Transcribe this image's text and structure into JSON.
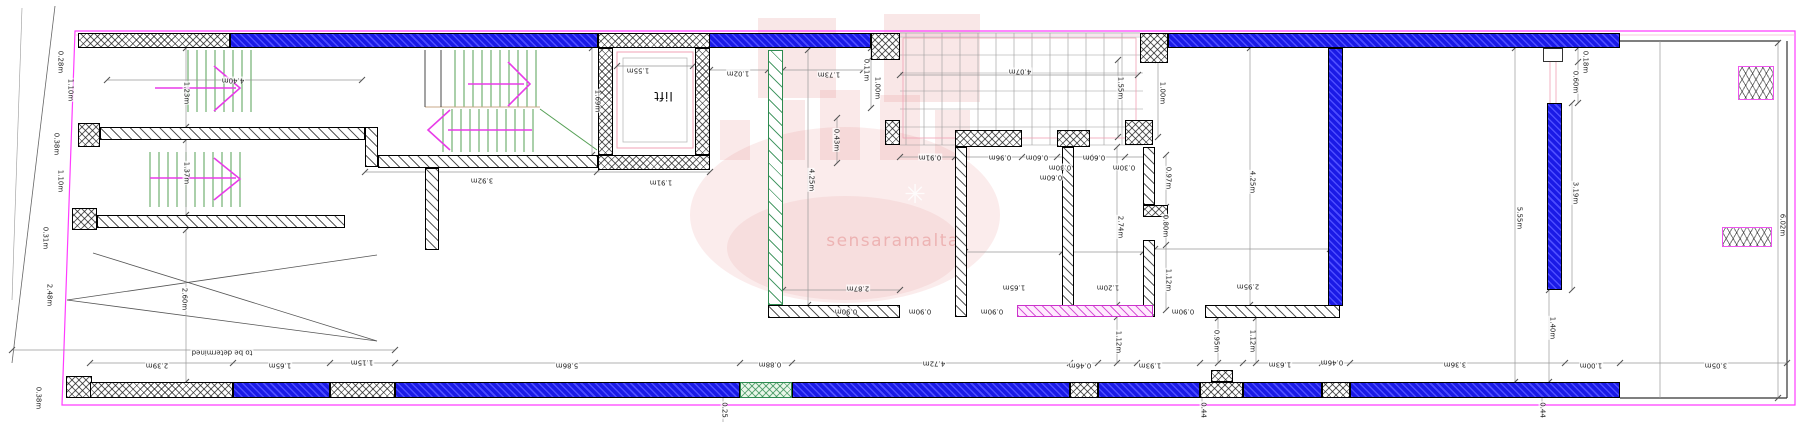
{
  "plan": {
    "type": "architectural-floor-plan",
    "units": "m",
    "watermark": "sensaramalta",
    "lift_label": "lift",
    "note": "to be determined"
  },
  "colors": {
    "wall_blue": "#1a1ae6",
    "wall_blue_hatch": "#4d4dff",
    "hatch_black": "#333333",
    "stair_green": "#55a055",
    "wall_green": "#2e8b50",
    "arrow_magenta": "#e83ce8",
    "boundary_magenta": "#ff3cff",
    "wall_magenta": "#cc33cc",
    "dim_line": "#999999",
    "aux_pink": "#f0a0b4",
    "watermark_red": "#e07878"
  },
  "labels": [
    {
      "t": "0.28m",
      "x": 60,
      "y": 62,
      "r": 90
    },
    {
      "t": "1.10m",
      "x": 70,
      "y": 90,
      "r": 90
    },
    {
      "t": "0.38m",
      "x": 56,
      "y": 144,
      "r": 90
    },
    {
      "t": "1.10m",
      "x": 60,
      "y": 181,
      "r": 90
    },
    {
      "t": "0.31m",
      "x": 45,
      "y": 238,
      "r": 90
    },
    {
      "t": "2.48m",
      "x": 49,
      "y": 295,
      "r": 90
    },
    {
      "t": "0.38m",
      "x": 38,
      "y": 398,
      "r": 90
    },
    {
      "t": "1.23m",
      "x": 186,
      "y": 93,
      "r": 90
    },
    {
      "t": "4.40m",
      "x": 233,
      "y": 80,
      "r": 180
    },
    {
      "t": "1.37m",
      "x": 186,
      "y": 173,
      "r": 90
    },
    {
      "t": "2.60m",
      "x": 184,
      "y": 299,
      "r": 90
    },
    {
      "t": "3.92m",
      "x": 482,
      "y": 180,
      "r": 180
    },
    {
      "t": "1.69m",
      "x": 597,
      "y": 101,
      "r": 90
    },
    {
      "t": "1.55m",
      "x": 638,
      "y": 70,
      "r": 180
    },
    {
      "t": "lift",
      "x": 663,
      "y": 96,
      "r": 180,
      "n": "lift-label"
    },
    {
      "t": "1.91m",
      "x": 661,
      "y": 182,
      "r": 180
    },
    {
      "t": "1.02m",
      "x": 738,
      "y": 73,
      "r": 180
    },
    {
      "t": "1.73m",
      "x": 829,
      "y": 74,
      "r": 180
    },
    {
      "t": "0.11m",
      "x": 866,
      "y": 70,
      "r": 90
    },
    {
      "t": "1.00m",
      "x": 877,
      "y": 88,
      "r": 90
    },
    {
      "t": "0.43m",
      "x": 836,
      "y": 140,
      "r": 90
    },
    {
      "t": "4.25m",
      "x": 811,
      "y": 180,
      "r": 90
    },
    {
      "t": "4.07m",
      "x": 1020,
      "y": 71,
      "r": 180
    },
    {
      "t": "1.55m",
      "x": 1120,
      "y": 88,
      "r": 90
    },
    {
      "t": "1.00m",
      "x": 1162,
      "y": 93,
      "r": 90
    },
    {
      "t": "0.91m",
      "x": 930,
      "y": 157,
      "r": 180
    },
    {
      "t": "0.96m",
      "x": 1000,
      "y": 157,
      "r": 180
    },
    {
      "t": "0.60m",
      "x": 1037,
      "y": 157,
      "r": 180
    },
    {
      "t": "0.30m",
      "x": 1060,
      "y": 167,
      "r": 180
    },
    {
      "t": "0.60m",
      "x": 1094,
      "y": 157,
      "r": 180
    },
    {
      "t": "0.30m",
      "x": 1124,
      "y": 167,
      "r": 180
    },
    {
      "t": "0.60m",
      "x": 1051,
      "y": 177,
      "r": 180
    },
    {
      "t": "0.97m",
      "x": 1168,
      "y": 178,
      "r": 90
    },
    {
      "t": "0.80m",
      "x": 1165,
      "y": 226,
      "r": 90
    },
    {
      "t": "2.74m",
      "x": 1120,
      "y": 227,
      "r": 90
    },
    {
      "t": "4.25m",
      "x": 1252,
      "y": 182,
      "r": 90
    },
    {
      "t": "1.65m",
      "x": 1014,
      "y": 287,
      "r": 180
    },
    {
      "t": "1.20m",
      "x": 1108,
      "y": 287,
      "r": 180
    },
    {
      "t": "1.12m",
      "x": 1168,
      "y": 280,
      "r": 90
    },
    {
      "t": "2.95m",
      "x": 1248,
      "y": 286,
      "r": 180
    },
    {
      "t": "2.87m",
      "x": 858,
      "y": 288,
      "r": 180
    },
    {
      "t": "0.90m",
      "x": 846,
      "y": 311,
      "r": 180
    },
    {
      "t": "0.90m",
      "x": 920,
      "y": 311,
      "r": 180
    },
    {
      "t": "0.90m",
      "x": 992,
      "y": 311,
      "r": 180
    },
    {
      "t": "0.90m",
      "x": 1183,
      "y": 311,
      "r": 180
    },
    {
      "t": "1.12m",
      "x": 1118,
      "y": 342,
      "r": 90
    },
    {
      "t": "0.95m",
      "x": 1216,
      "y": 341,
      "r": 90
    },
    {
      "t": "1.12m",
      "x": 1252,
      "y": 341,
      "r": 90
    },
    {
      "t": "to be determined",
      "x": 222,
      "y": 352,
      "r": 180,
      "n": "note-label"
    },
    {
      "t": "2.39m",
      "x": 157,
      "y": 365,
      "r": 180
    },
    {
      "t": "1.65m",
      "x": 280,
      "y": 365,
      "r": 180
    },
    {
      "t": "1.15m",
      "x": 362,
      "y": 362,
      "r": 180
    },
    {
      "t": "5.86m",
      "x": 567,
      "y": 365,
      "r": 180
    },
    {
      "t": "0.88m",
      "x": 770,
      "y": 364,
      "r": 180
    },
    {
      "t": "4.72m",
      "x": 934,
      "y": 363,
      "r": 180
    },
    {
      "t": "0.46m",
      "x": 1080,
      "y": 365,
      "r": 180
    },
    {
      "t": "1.93m",
      "x": 1150,
      "y": 365,
      "r": 180
    },
    {
      "t": "1.63m",
      "x": 1280,
      "y": 364,
      "r": 180
    },
    {
      "t": "0.46m",
      "x": 1332,
      "y": 362,
      "r": 180
    },
    {
      "t": "3.36m",
      "x": 1455,
      "y": 364,
      "r": 180
    },
    {
      "t": "1.00m",
      "x": 1591,
      "y": 365,
      "r": 180
    },
    {
      "t": "3.05m",
      "x": 1716,
      "y": 365,
      "r": 180
    },
    {
      "t": "0.25",
      "x": 724,
      "y": 410,
      "r": 90
    },
    {
      "t": "0.44",
      "x": 1203,
      "y": 410,
      "r": 90
    },
    {
      "t": "0.44",
      "x": 1542,
      "y": 410,
      "r": 90
    },
    {
      "t": "5.55m",
      "x": 1519,
      "y": 218,
      "r": 90
    },
    {
      "t": "3.19m",
      "x": 1575,
      "y": 193,
      "r": 90
    },
    {
      "t": "0.60m",
      "x": 1575,
      "y": 82,
      "r": 90
    },
    {
      "t": "0.18m",
      "x": 1585,
      "y": 62,
      "r": 90
    },
    {
      "t": "1.40m",
      "x": 1552,
      "y": 328,
      "r": 90
    },
    {
      "t": "6.02m",
      "x": 1782,
      "y": 225,
      "r": 90
    }
  ]
}
